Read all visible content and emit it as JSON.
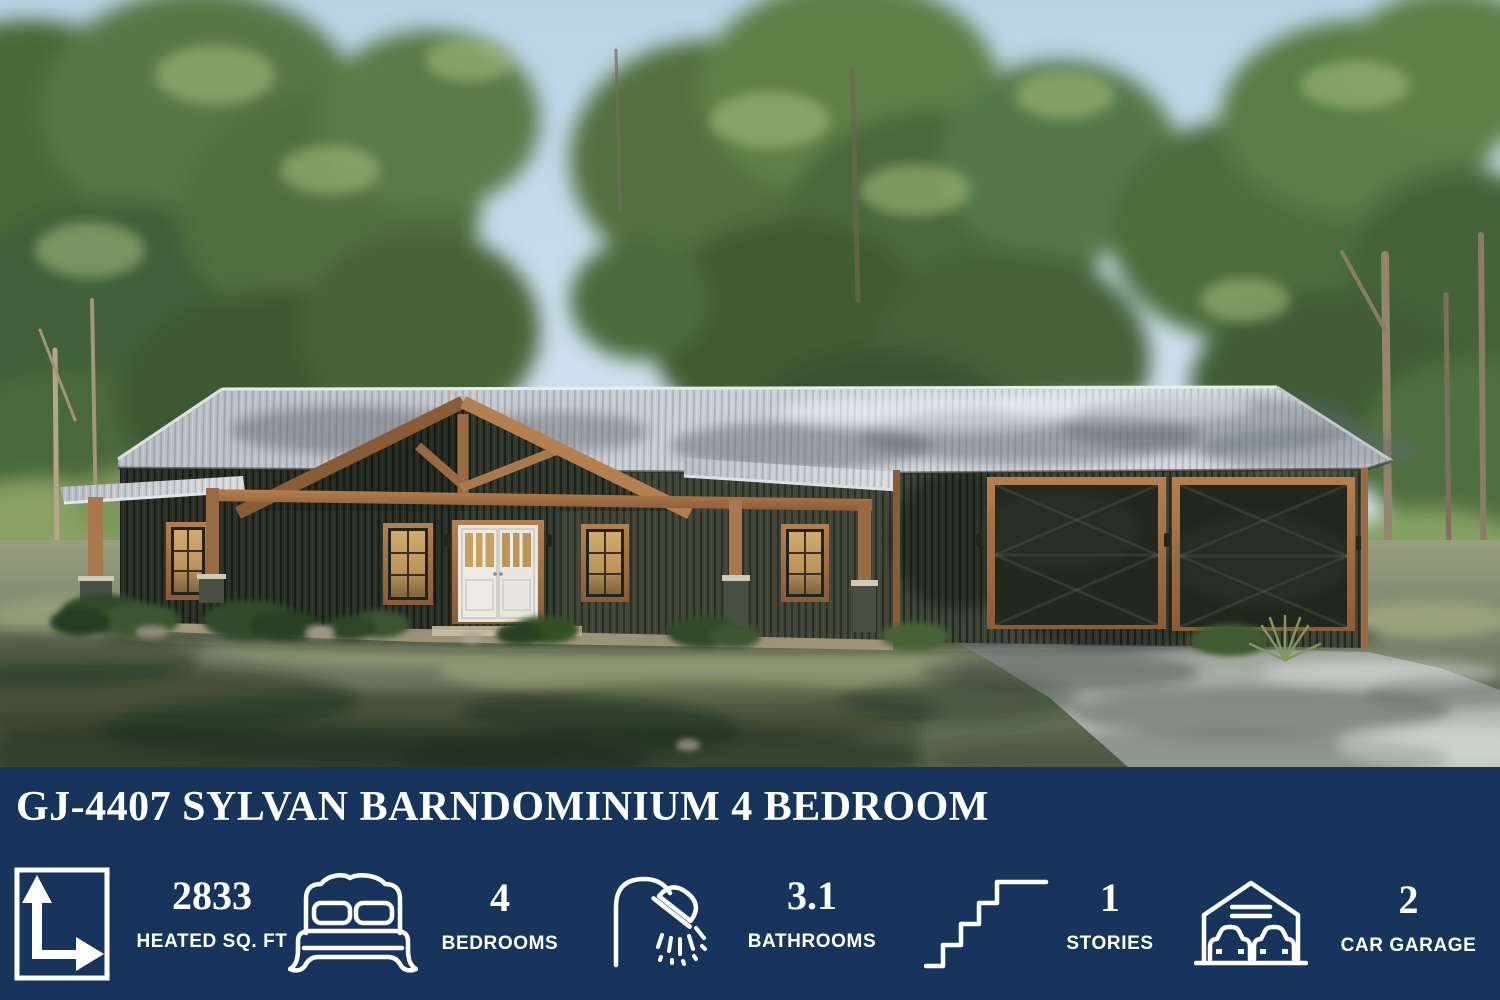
{
  "banner": {
    "bg_color": "#17345c",
    "text_color": "#ffffff",
    "title": "GJ-4407 SYLVAN BARNDOMINIUM 4 BEDROOM",
    "stats": [
      {
        "icon": "square-feet-dimension-icon",
        "value": "2833",
        "label": "HEATED SQ. FT"
      },
      {
        "icon": "bed-icon",
        "value": "4",
        "label": "BEDROOMS"
      },
      {
        "icon": "shower-icon",
        "value": "3.1",
        "label": "BATHROOMS"
      },
      {
        "icon": "stairs-icon",
        "value": "1",
        "label": "STORIES"
      },
      {
        "icon": "garage-cars-icon",
        "value": "2",
        "label": "CAR GARAGE"
      }
    ]
  },
  "scene": {
    "description": "Front exterior rendering of a dark-sided barndominium with cedar gable truss, covered porch and attached two-car garage, surrounded by tall trees with a concrete driveway at right",
    "colors": {
      "sky": "#c3d9e8",
      "roof": "#c9cdd3",
      "siding": "#343b30",
      "wood_trim": "#a9784c",
      "lawn": "#76816a",
      "driveway": "#b2b5b0",
      "window_glow": "#c79d5d"
    }
  }
}
